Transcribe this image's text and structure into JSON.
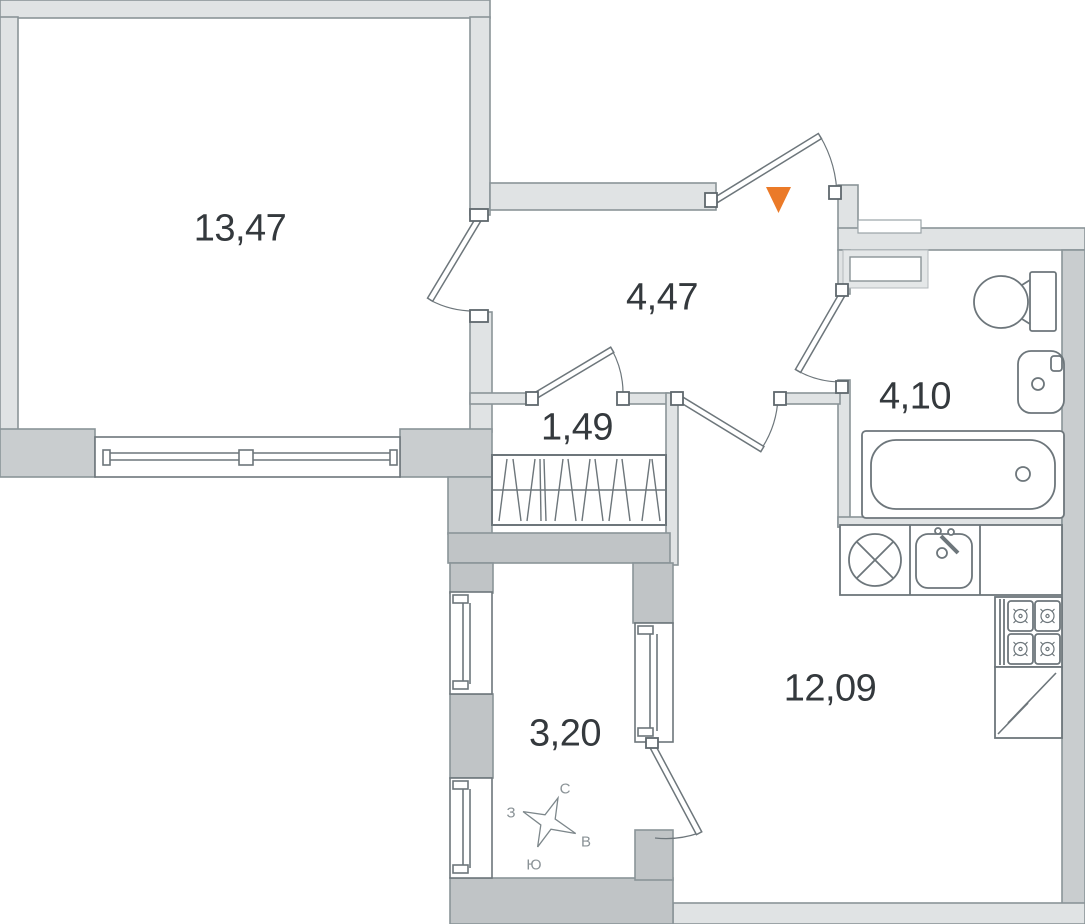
{
  "plan": {
    "type": "apartment-floor-plan",
    "rooms": [
      {
        "id": "living-room",
        "area": "13,47"
      },
      {
        "id": "hallway",
        "area": "4,47"
      },
      {
        "id": "closet",
        "area": "1,49"
      },
      {
        "id": "bathroom",
        "area": "4,10"
      },
      {
        "id": "kitchen-living",
        "area": "12,09"
      },
      {
        "id": "balcony",
        "area": "3,20"
      }
    ],
    "compass": {
      "north": "С",
      "east": "В",
      "south": "Ю",
      "west": "З"
    },
    "colors": {
      "wall_light": "#e0e3e4",
      "wall_medium": "#c9cdcf",
      "wall_dark": "#c0c4c6",
      "wall_outline": "#8a9498",
      "fixture_outline": "#6d767b",
      "entrance_marker": "#eb7a28",
      "area_text": "#34393d",
      "compass_text": "#8a9296"
    },
    "icons": [
      "entrance-arrow-icon",
      "compass-rose-icon",
      "toilet-icon",
      "sink-icon",
      "bathtub-icon",
      "washing-machine-icon",
      "kitchen-sink-icon",
      "stove-icon",
      "fridge-icon",
      "wardrobe-icon"
    ]
  }
}
